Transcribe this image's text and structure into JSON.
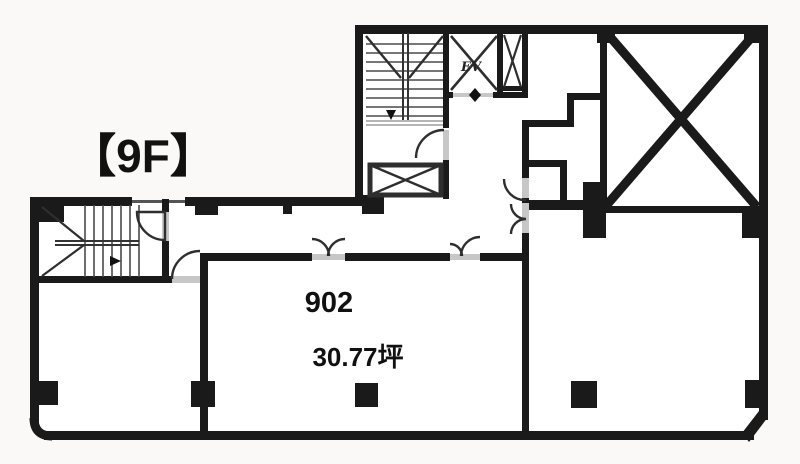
{
  "floor_plan": {
    "floor_label": "【9F】",
    "elevator_label": "EV",
    "unit": {
      "number": "902",
      "area": "30.77坪"
    },
    "colors": {
      "wall": "#1a1a1a",
      "line": "#333333",
      "background": "#faf9f7",
      "room": "#ffffff",
      "sill": "#c7c7c7",
      "text": "#111111"
    }
  }
}
